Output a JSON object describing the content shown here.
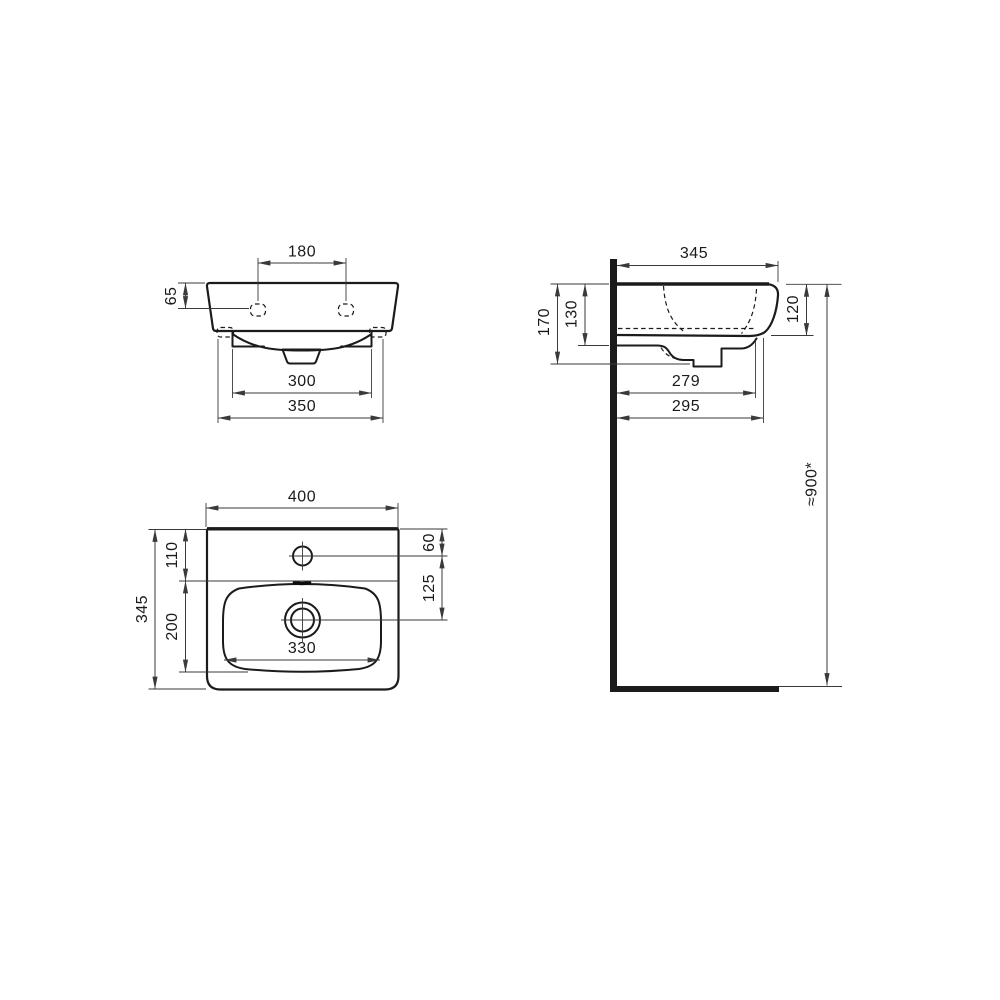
{
  "colors": {
    "background": "#ffffff",
    "object_line": "#1b1b1b",
    "dimension_line": "#3a3a3a",
    "text": "#1a1a1a"
  },
  "views": {
    "front": {
      "dims": {
        "tap_hole_spacing": "180",
        "rim_to_tap_hole": "65",
        "bowl_shelf_width": "300",
        "fixing_holes_width": "350"
      }
    },
    "side": {
      "dims": {
        "depth": "345",
        "height_overall": "170",
        "height_bowl": "130",
        "height_front_edge": "120",
        "drain_wall_distance": "279",
        "front_wall_distance": "295",
        "mounting_height": "≈900*"
      }
    },
    "plan": {
      "dims": {
        "width": "400",
        "front_to_tap": "110",
        "tap_to_bowl_end": "200",
        "depth": "345",
        "edge_to_tap_center": "60",
        "tap_to_drain_center": "125",
        "bowl_width": "330"
      }
    }
  }
}
